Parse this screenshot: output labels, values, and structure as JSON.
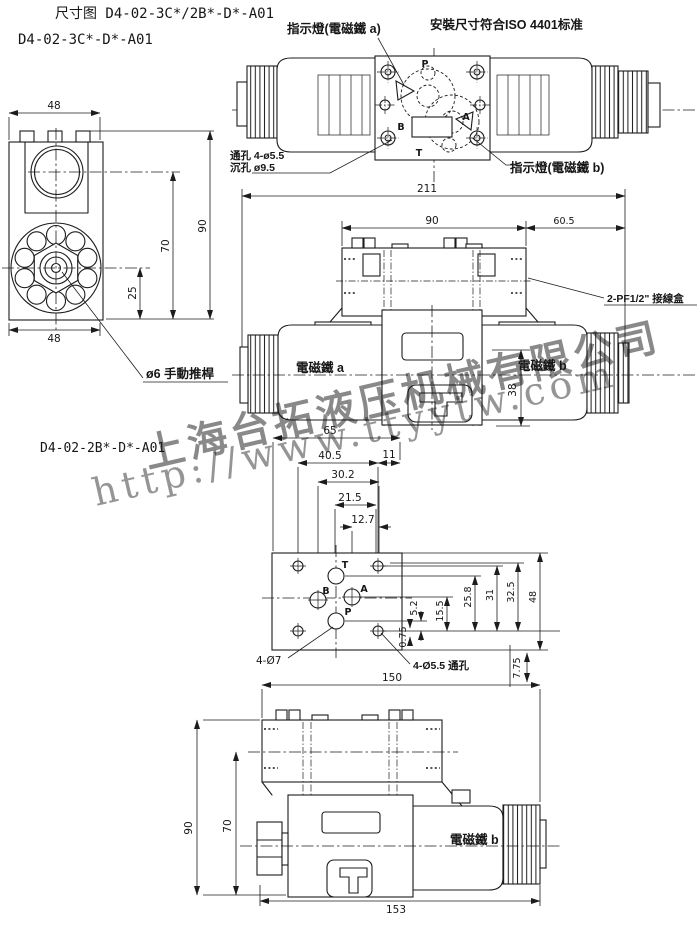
{
  "meta": {
    "bg": "#ffffff",
    "ink": "#1c1c1c",
    "watermark_color": "#6d9be0"
  },
  "header": {
    "title_line1": "尺寸图 D4-02-3C*/2B*-D*-A01",
    "title_line2": "D4-02-3C*-D*-A01",
    "iso_note": "安裝尺寸符合ISO 4401标准"
  },
  "top_view": {
    "indicator_a": "指示燈(電磁鐵 a)",
    "indicator_b": "指示燈(電磁鐵 b)",
    "hole_note_line1": "通孔 4-ø5.5",
    "hole_note_line2": "沉孔 ø9.5",
    "ports": {
      "p": "P",
      "t": "T",
      "a": "A",
      "b": "B"
    }
  },
  "side_view": {
    "dim_width_top": "48",
    "dim_width_bottom": "48",
    "dim_height": "90",
    "dim_center_height": "70",
    "dim_offset": "25",
    "manual_pin_label": "ø6 手動推桿"
  },
  "front_view": {
    "dim_overall": "211",
    "dim_body": "90",
    "dim_solenoid": "60.5",
    "dim_height": "38",
    "solenoid_a": "電磁鐵 a",
    "solenoid_b": "電磁鐵 b",
    "terminal_box": "2-PF1/2\" 接線盒"
  },
  "mounting_view": {
    "model": "D4-02-2B*-D*-A01",
    "dim_65": "65",
    "dim_40_5": "40.5",
    "dim_11": "11",
    "dim_30_2": "30.2",
    "dim_21_5": "21.5",
    "dim_12_7": "12.7",
    "dim_5_2": "5.2",
    "dim_15_5": "15.5",
    "dim_25_8": "25.8",
    "dim_31": "31",
    "dim_32_5": "32.5",
    "dim_48": "48",
    "dim_0_75": "0.75",
    "dim_7_75": "7.75",
    "dim_150": "150",
    "holes_label_1": "4-Ø7",
    "holes_label_2": "4-Ø5.5 通孔",
    "ports": {
      "t": "T",
      "b": "B",
      "a": "A",
      "p": "P"
    }
  },
  "bottom_view": {
    "dim_height": "90",
    "dim_center_height": "70",
    "dim_length": "153",
    "solenoid_b": "電磁鐵 b"
  },
  "watermark": {
    "company": "上海台拓液压机械有限公司",
    "url": "http://www.ttyytw.com"
  }
}
